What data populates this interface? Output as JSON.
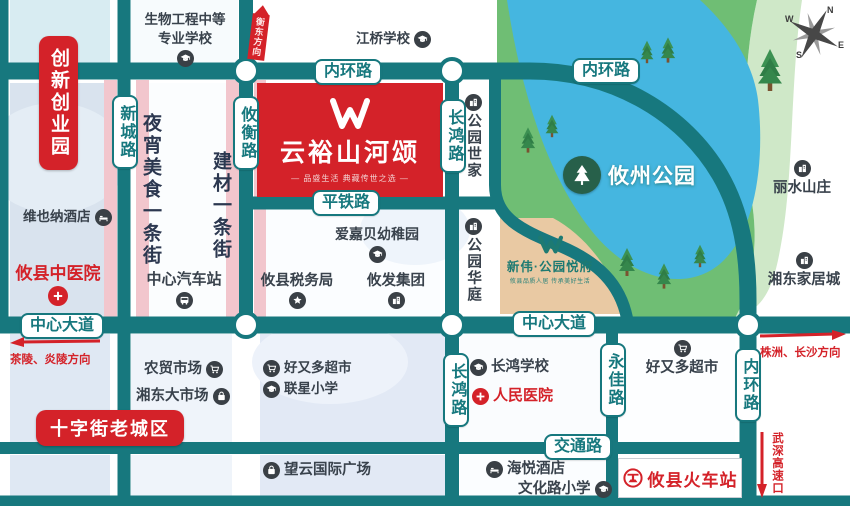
{
  "colors": {
    "road_teal": "#17787e",
    "brand_red": "#d42229",
    "pink_strip": "#f2c6cd",
    "park_green": "#6fbe74",
    "lake_blue": "#45b6e0",
    "tan_block": "#e9c9a3",
    "icon_dark": "#3a4046",
    "second_teal": "#1d7a72"
  },
  "compass": {
    "n": "N",
    "e": "E",
    "s": "S",
    "w": "W"
  },
  "project_main": {
    "name": "云裕山河颂",
    "tagline": "— 品盛生活 典藏传世之选 —"
  },
  "project_second": {
    "name": "新伟·公园悦府",
    "tagline": "攸县品质人居 传承美好生活"
  },
  "park": {
    "name": "攸州公园"
  },
  "roads": {
    "neihuan": "内环路",
    "pingtie": "平铁路",
    "zhongxin": "中心大道",
    "jiaotong": "交通路",
    "xincheng": "新城路",
    "youheng": "攸衡路",
    "changhong": "长鸿路",
    "yongjia": "永佳路"
  },
  "directions": {
    "hengdong": "衡东方向",
    "chaling": "茶陵、炎陵方向",
    "zhuzhou": "株洲、长沙方向",
    "wushen": "武深高速口"
  },
  "areas": {
    "chuangxin": "创新创业园",
    "shizijie": "十字街老城区",
    "yexiao": "夜宵美食一条街",
    "jiancai": "建材一条街"
  },
  "pois": {
    "bio_school_line1": "生物工程中等",
    "bio_school_line2": "专业学校",
    "jiangqiao": "江桥学校",
    "vienna": "维也纳酒店",
    "zhongyi": "攸县中医院",
    "qichezhan": "中心汽车站",
    "aijiabei": "爱嘉贝幼稚园",
    "shuiwu": "攸县税务局",
    "youfa": "攸发集团",
    "shijia": "公园世家",
    "huating": "公园华庭",
    "lishui": "丽水山庄",
    "xiangdong_home": "湘东家居城",
    "nongmao": "农贸市场",
    "xiangdong_market": "湘东大市场",
    "haoyouduo_left": "好又多超市",
    "lianxing": "联星小学",
    "wangyun": "望云国际广场",
    "changhong_school": "长鸿学校",
    "renmin": "人民医院",
    "haoyouduo_right": "好又多超市",
    "haiyue": "海悦酒店",
    "wenhua": "文化路小学",
    "huochezhan": "攸县火车站"
  }
}
